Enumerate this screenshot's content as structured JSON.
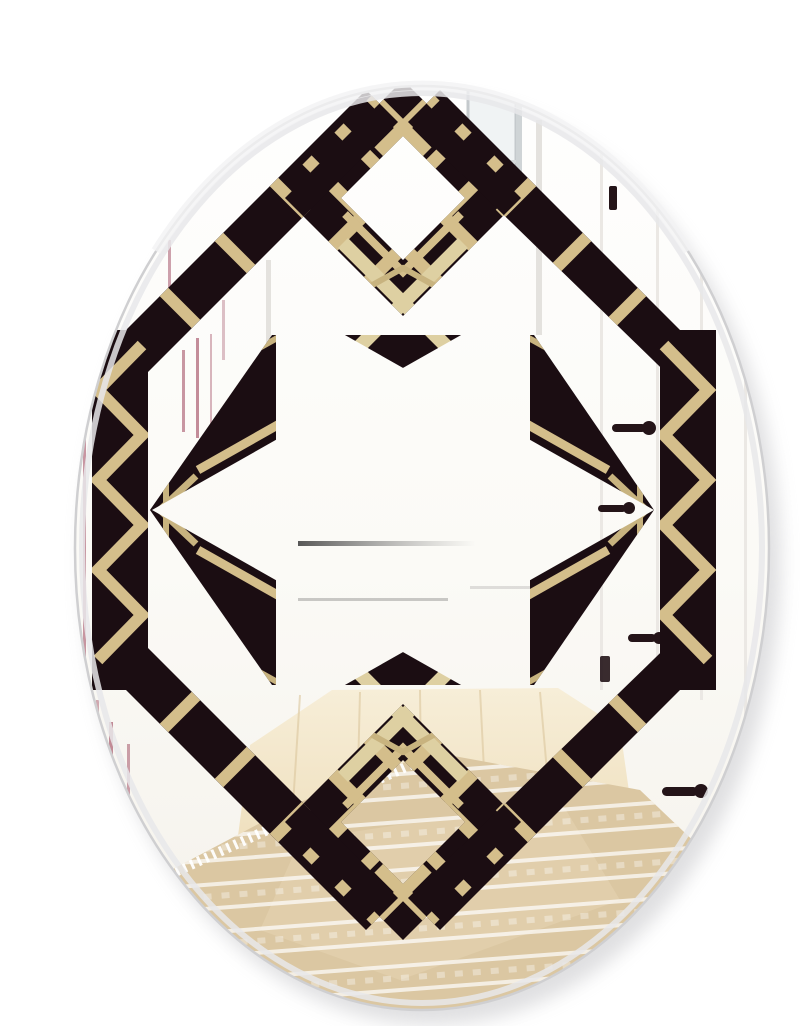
{
  "meta": {
    "title": "Oval wall mirror with black and gold art deco geometric pattern reflecting a white hallway",
    "image_type": "product-photo",
    "no_visible_text": true
  },
  "palette": {
    "pattern_black": "#1b0d12",
    "pattern_gold": "#d4be8b",
    "pattern_gold_light": "#ded0a2",
    "pattern_gold_deep": "#c8b37f",
    "wall_white": "#fcfbf8",
    "wood_floor": "#e9d6ac",
    "rug_beige": "#dbc7a2",
    "frame_maroon": "#93314b",
    "handle_black": "#241418",
    "rim_gray": "#cfcfd1",
    "shadow_gray": "#b9b9bd"
  },
  "scene": {
    "mirror_shape": "oval",
    "pattern_style": "art deco lattice: top and bottom striped diamonds, chevron-striped side columns, central hexagram star with gold cross accents",
    "reflection_items": [
      "white hallway walls",
      "white doors with black lever handles",
      "reflected picture frame edges",
      "small bright window",
      "white sideboard shadow line",
      "light wood floor",
      "beige striped area rug with white fringe"
    ],
    "counts": {
      "door_handles": 5,
      "dark_fixtures": 2,
      "frame_edge_lines": 9,
      "gold_diamond_rungs": 20
    }
  }
}
